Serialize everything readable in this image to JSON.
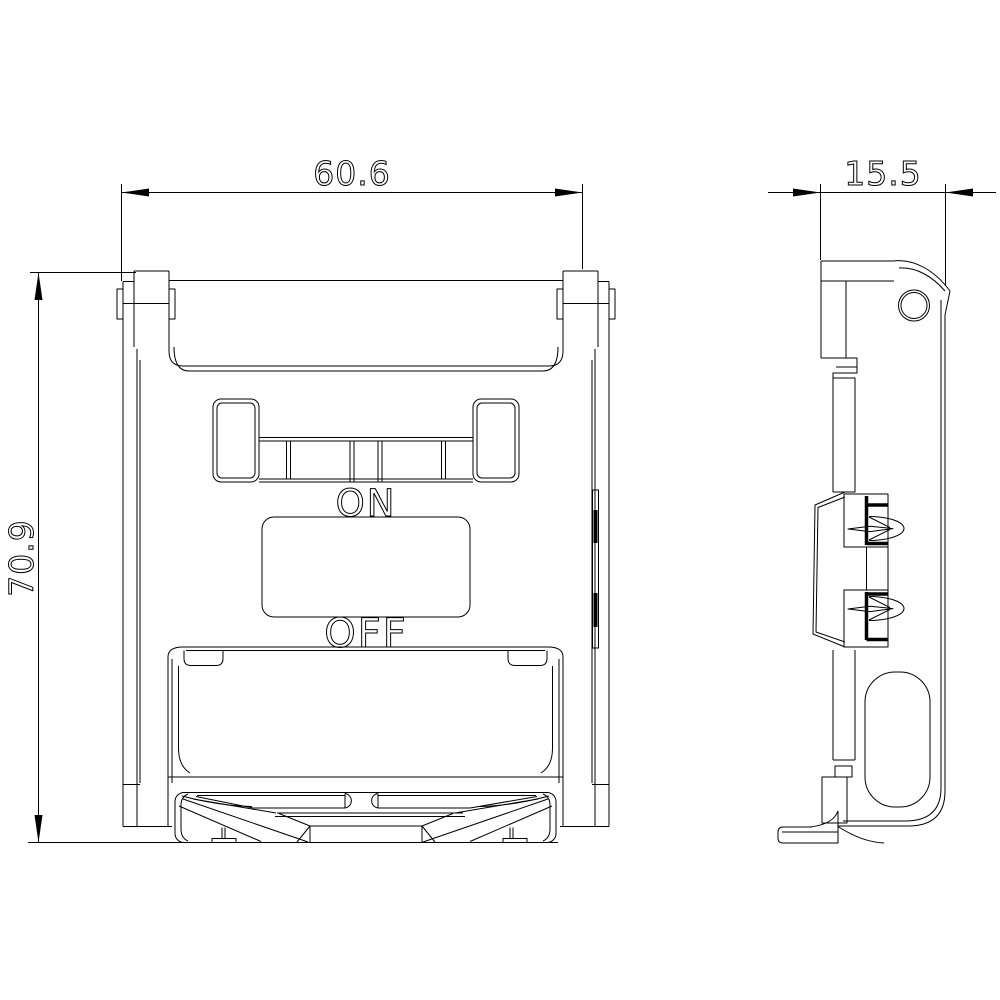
{
  "drawing": {
    "type": "technical-dimension-drawing",
    "part": "switch-front-and-side-view",
    "background": "#ffffff",
    "line_color": "#000000"
  },
  "dimensions": {
    "width": {
      "value": "60.6"
    },
    "height": {
      "value": "70.9"
    },
    "depth": {
      "value": "15.5"
    }
  },
  "labels": {
    "on": "ON",
    "off": "OFF"
  }
}
